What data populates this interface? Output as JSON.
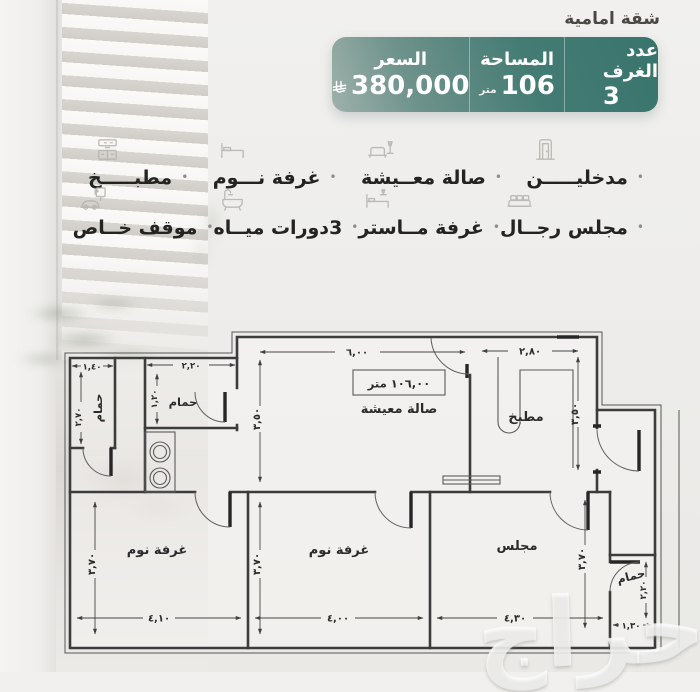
{
  "header": {
    "tag": "شقة امامية",
    "card": {
      "rooms_label": "عدد الغرف",
      "rooms_value": "3",
      "area_label": "المساحة",
      "area_value": "106",
      "area_unit": "متر",
      "price_label": "السعر",
      "price_value": "380,000",
      "currency_icon": "saudi-riyal-symbol"
    }
  },
  "features": {
    "separator": "•",
    "parking_sign": "P",
    "row1": [
      {
        "label": "مدخليـــــن",
        "icon": "door-icon"
      },
      {
        "label": "صالة معــيشة",
        "icon": "sofa-lamp-icon"
      },
      {
        "label": "غرفة نـــوم",
        "icon": "bed-icon"
      },
      {
        "label": "مطبـــــخ",
        "icon": "kitchen-cabinet-icon"
      }
    ],
    "row2": [
      {
        "label": "مجلس رجــال",
        "icon": "majlis-seating-icon"
      },
      {
        "label": "غرفة مــاستر",
        "icon": "master-bed-icon"
      },
      {
        "label": "3دورات ميــاه",
        "icon": "bathtub-icon"
      },
      {
        "label": "موقف خــاص",
        "icon": "car-parking-icon"
      }
    ]
  },
  "floor_plan": {
    "area_box_label": "١٠٦,٠٠ متر",
    "rooms": {
      "living": "صالة معيشة",
      "kitchen": "مطبخ",
      "bath": "حمام",
      "bedroom": "غرفة نوم",
      "majlis": "مجلس"
    },
    "dims": {
      "living_w": "٦,٠٠",
      "living_h": "٣,٥٠",
      "kitchen_w": "٢,٨٠",
      "kitchen_h": "٣,٥٠",
      "bath1_w": "١,٤٠",
      "bath1_h": "٢,٧٠",
      "bath2_w": "٢,٢٠",
      "bath2_h": "١,٢٠",
      "bed1_w": "٤,١٠",
      "bed2_w": "٤,٠٠",
      "majlis_w": "٤,٣٠",
      "room_h": "٣,٧٠",
      "bath3_w": "١,٣٠",
      "bath3_h": "٢,٢٠"
    }
  },
  "watermark": "حراج"
}
